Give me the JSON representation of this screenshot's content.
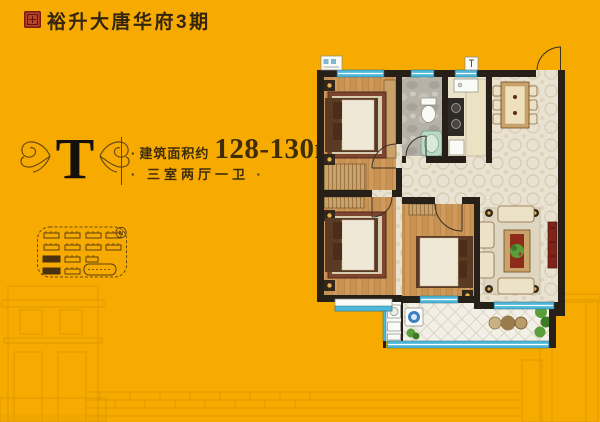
{
  "header": {
    "brand_title": "裕升大唐华府3期"
  },
  "unit_info": {
    "type_letter": "T",
    "area_bullet": "·",
    "area_label": "建筑面积约",
    "area_value": "128-130m",
    "area_superscript": "2",
    "layout_text": "· 三室两厅一卫 ·"
  },
  "site_map": {
    "compass_label": "N"
  },
  "colors": {
    "background": "#F7AB00",
    "ink": "#33250F",
    "seal_red": "#B5442A",
    "window_blue": "#4FB8D8",
    "wall_dark": "#262019",
    "wood_floor": "#CF9A5C",
    "tile_floor": "#E9E2D1"
  }
}
